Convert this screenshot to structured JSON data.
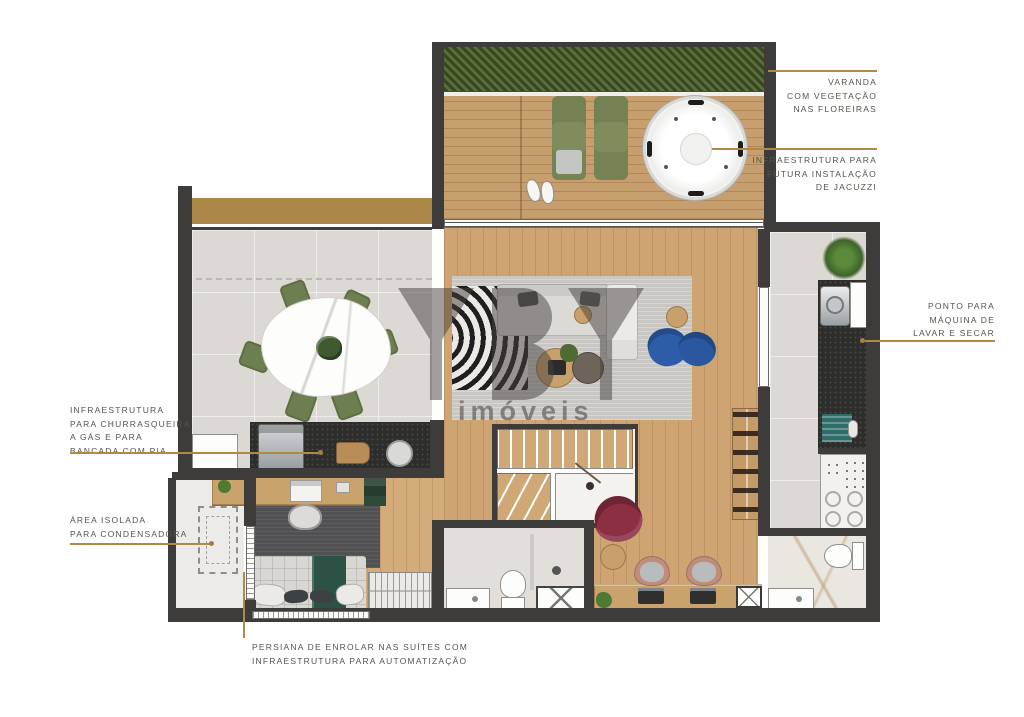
{
  "watermark": {
    "brand": "YBY",
    "sub": "imóveis"
  },
  "annotations": {
    "varanda": {
      "lines": [
        "VARANDA",
        "COM VEGETAÇÃO",
        "NAS FLOREIRAS"
      ]
    },
    "jacuzzi": {
      "lines": [
        "INFRAESTRUTURA PARA",
        "FUTURA INSTALAÇÃO",
        "DE JACUZZI"
      ]
    },
    "lavanderia": {
      "lines": [
        "PONTO PARA",
        "MÁQUINA DE",
        "LAVAR E SECAR"
      ]
    },
    "churrasqueira": {
      "lines": [
        "INFRAESTRUTURA",
        "PARA CHURRASQUEIRA",
        "A GÁS E PARA",
        "BANCADA COM PIA"
      ]
    },
    "condensadora": {
      "lines": [
        "ÁREA ISOLADA",
        "PARA CONDENSADORA"
      ]
    },
    "persiana": {
      "lines": [
        "PERSIANA DE ENROLAR NAS SUÍTES COM",
        "INFRAESTRUTURA PARA AUTOMATIZAÇÃO"
      ]
    }
  },
  "colors": {
    "leader_line": "#b08948",
    "wall": "#3d3c3a",
    "wood_floor": "#cfa473",
    "tile_floor": "#dcd9d4",
    "deck": "#c79e6e",
    "hedge": "#485c33",
    "chair_green": "#6d7f50",
    "armchair_blue": "#2d5da8",
    "armchair_red": "#8d2f43",
    "label_text": "#57534d",
    "watermark": "#46403a"
  }
}
